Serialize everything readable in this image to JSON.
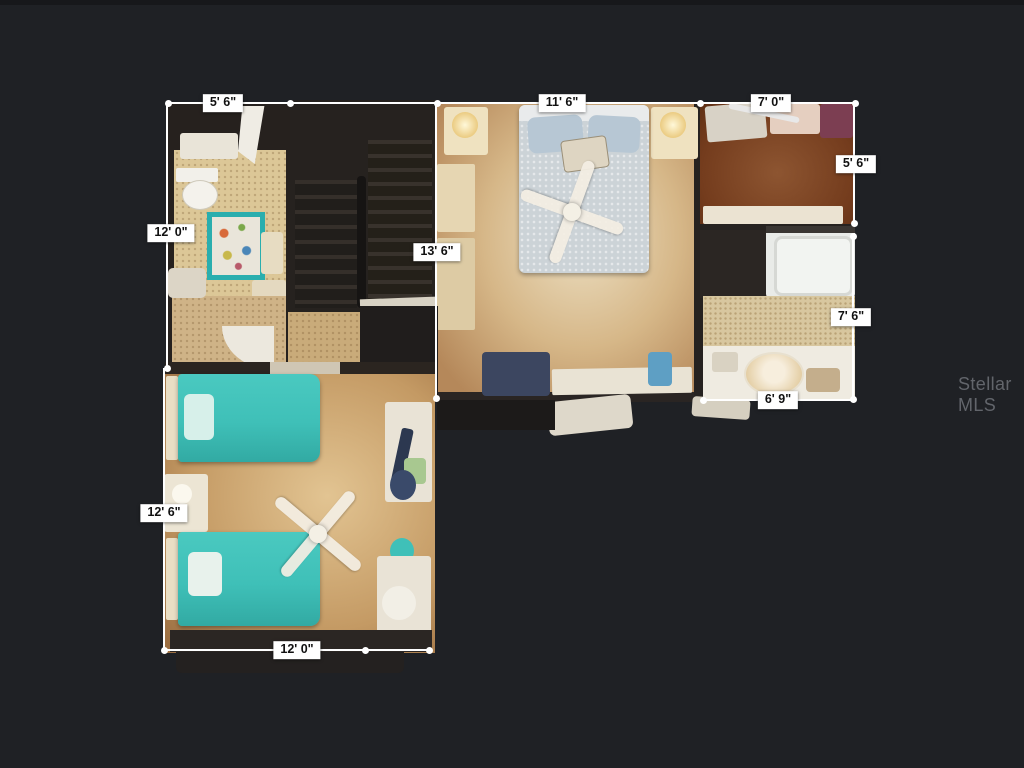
{
  "watermark": {
    "text": "Stellar MLS"
  },
  "dimensions": [
    {
      "name": "bathroom-1-width",
      "label": "5' 6\""
    },
    {
      "name": "primary-bedroom-width",
      "label": "11' 6\""
    },
    {
      "name": "closet-width",
      "label": "7' 0\""
    },
    {
      "name": "left-wing-height",
      "label": "12' 0\""
    },
    {
      "name": "primary-bedroom-height",
      "label": "13' 6\""
    },
    {
      "name": "closet-height",
      "label": "5' 6\""
    },
    {
      "name": "bathroom-2-height",
      "label": "7' 6\""
    },
    {
      "name": "bathroom-2-width",
      "label": "6' 9\""
    },
    {
      "name": "bedroom-2-height",
      "label": "12' 6\""
    },
    {
      "name": "bedroom-2-width",
      "label": "12' 0\""
    }
  ],
  "palette": {
    "background": "#1f2125",
    "dimension_line": "#ffffff",
    "label_text": "#111111",
    "floor_tan": "#cfae7d",
    "closet_brown": "#7c4a28",
    "bed_teal": "#3fc0b8",
    "primary_bedding": "#ccd3d7",
    "stairs_dark": "#262220",
    "watermark_gray": "#62656b"
  }
}
